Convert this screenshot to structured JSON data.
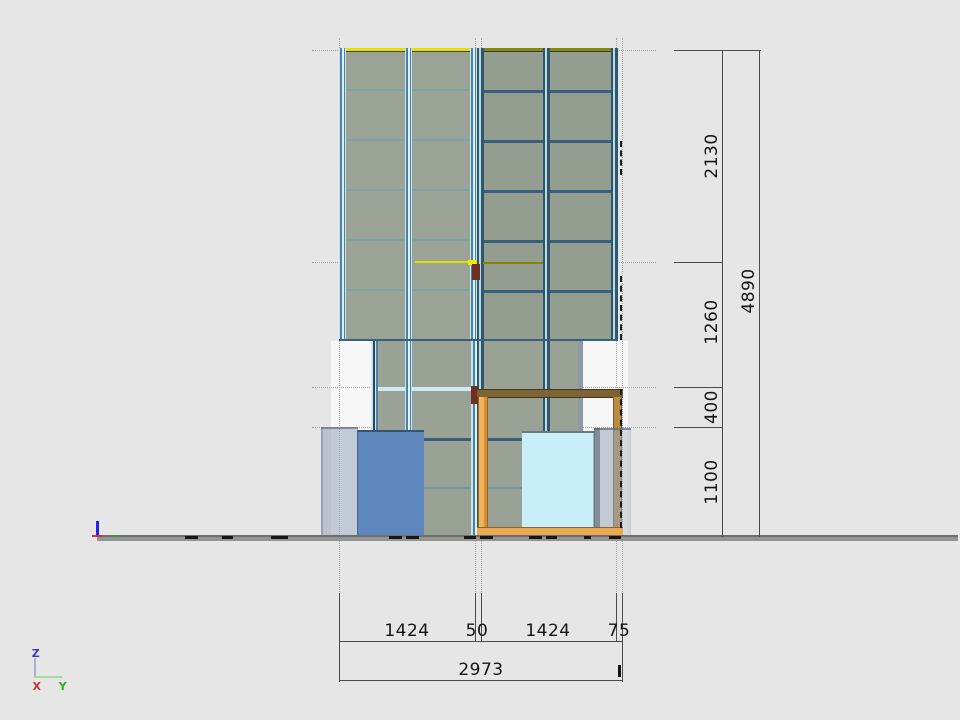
{
  "viewport": {
    "type": "cad-elevation-drawing",
    "background": "#e6e6e6"
  },
  "dimensions": {
    "right": [
      {
        "label": "2130"
      },
      {
        "label": "1260"
      },
      {
        "label": "400"
      },
      {
        "label": "1100"
      }
    ],
    "overall_height": {
      "label": "4890"
    },
    "bottom": [
      {
        "label": "1424"
      },
      {
        "label": "50"
      },
      {
        "label": "1424"
      },
      {
        "label": "75"
      }
    ],
    "overall_width": {
      "label": "2973"
    }
  },
  "axis_triad": {
    "x": "X",
    "y": "Y",
    "z": "Z"
  },
  "colors": {
    "glass_panel": "#9aa396",
    "mullion_light_cyan": "#c6e7ea",
    "mullion_steel_blue": "#4d80a8",
    "mullion_dark_navy": "#2f566d",
    "roof_edge_yellow": "#ecdf00",
    "roof_edge_olive": "#8b8000",
    "timber_beam_brown": "#7e6434",
    "timber_post_orange": "#eaa94e",
    "accent_maroon": "#6e2f24",
    "box_blue": "#5e88bd",
    "box_cyan": "#c9f0fa",
    "box_gray_translucent": "#9aa8bb",
    "ground_gray": "#949494",
    "dimension_line": "#4b4b4b",
    "axis_x_red": "#cc3333",
    "axis_y_green": "#2fae2f",
    "axis_z_blue": "#3a3acc"
  }
}
